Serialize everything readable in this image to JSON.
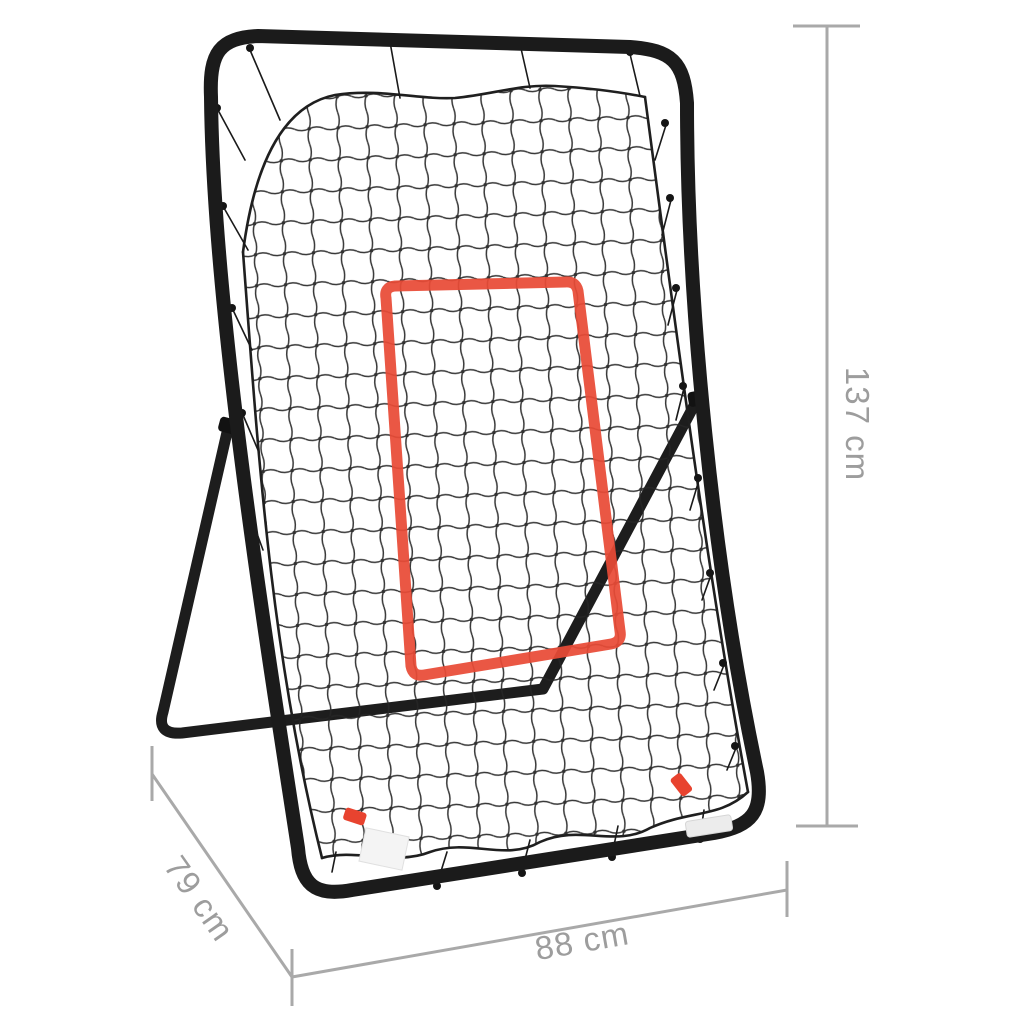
{
  "dimensions": {
    "height": {
      "label": "137 cm",
      "placement": "right-vertical"
    },
    "depth": {
      "label": "79 cm",
      "placement": "bottom-left-diagonal"
    },
    "width": {
      "label": "88 cm",
      "placement": "bottom-horizontal"
    }
  },
  "colors": {
    "background": "#ffffff",
    "frame": "#1b1b1b",
    "net": "#262626",
    "strike_zone_tape": "#e84a36",
    "dimension_lines": "#a9a9a9",
    "dimension_text": "#9d9d9d",
    "sticker_white": "#f4f4f4",
    "tab_red": "#e8432f"
  }
}
